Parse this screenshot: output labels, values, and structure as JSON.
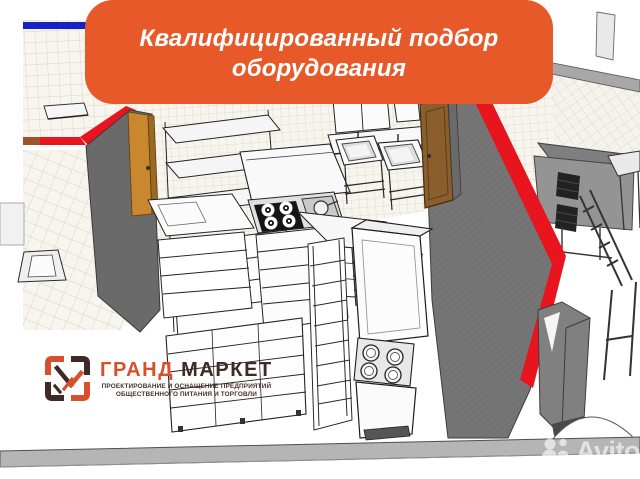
{
  "banner": {
    "line1": "Квалифицированный подбор",
    "line2": "оборудования",
    "bg_color": "#E8592A",
    "text_color": "#FFFFFF"
  },
  "logo": {
    "title_part1": "ГРАНД",
    "title_part2": "МАРКЕТ",
    "tagline_line1": "ПРОЕКТИРОВАНИЕ И ОСНАЩЕНИЕ ПРЕДПРИЯТИЙ",
    "tagline_line2": "ОБЩЕСТВЕННОГО ПИТАНИЯ И ТОРГОВЛИ",
    "primary_color": "#D8502B",
    "dark_color": "#3F2B26"
  },
  "watermark": {
    "brand": "Avito"
  },
  "scene_colors": {
    "accent_red": "#E8151E",
    "wall_gray": "#6E6E6E",
    "door_amber": "#C9882F",
    "door_brown": "#8B5E2E",
    "tile_bg": "#F8F5EF",
    "tile_line": "#D9D1C5",
    "blue_strip": "#1722C4",
    "base_band": "#B5B5B5"
  }
}
